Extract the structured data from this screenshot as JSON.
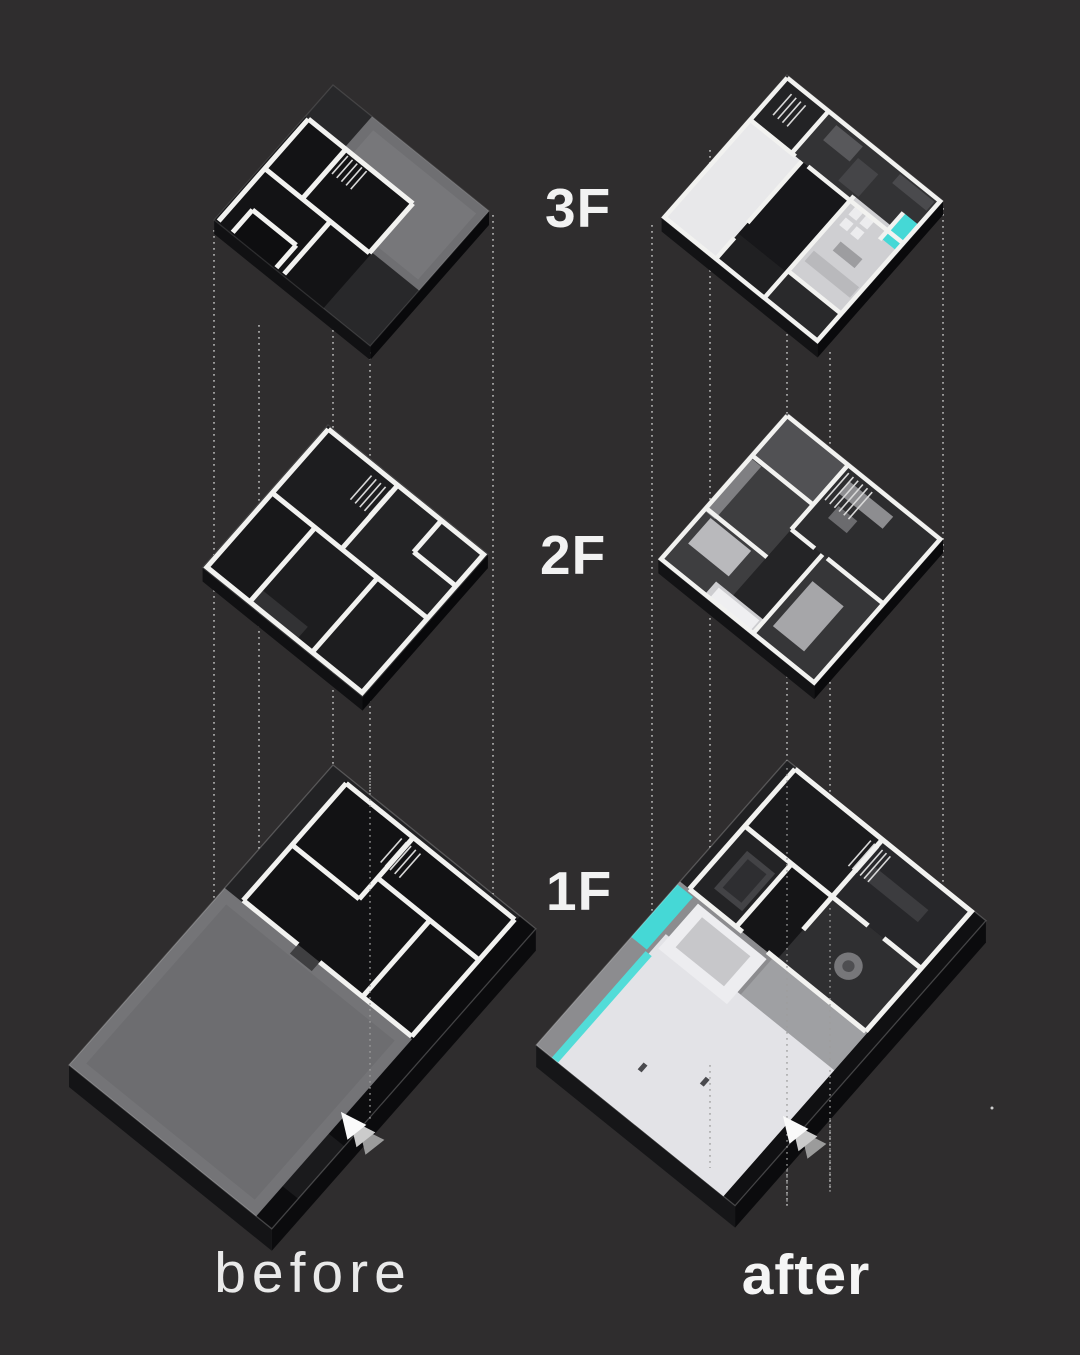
{
  "diagram": {
    "floor_labels": [
      "3F",
      "2F",
      "1F"
    ],
    "caption_before": "before",
    "caption_after": "after"
  },
  "palette": {
    "background": "#2f2d2e",
    "wall_white": "#f2f2f0",
    "accent_cyan": "#45d8d6",
    "dotted_line": "#c6c6c6",
    "dotted_line_front": "#9d9d9d",
    "label_text": "#f2f2f2",
    "roof_gray": "#6f6f72",
    "courtyard_gray": "#747477",
    "patio_white": "#e3e3e7",
    "arrow_white": "#fafafa"
  },
  "icons": {
    "north_arrow": "north-arrow-icon",
    "artifact_dot": "speck-dot"
  }
}
